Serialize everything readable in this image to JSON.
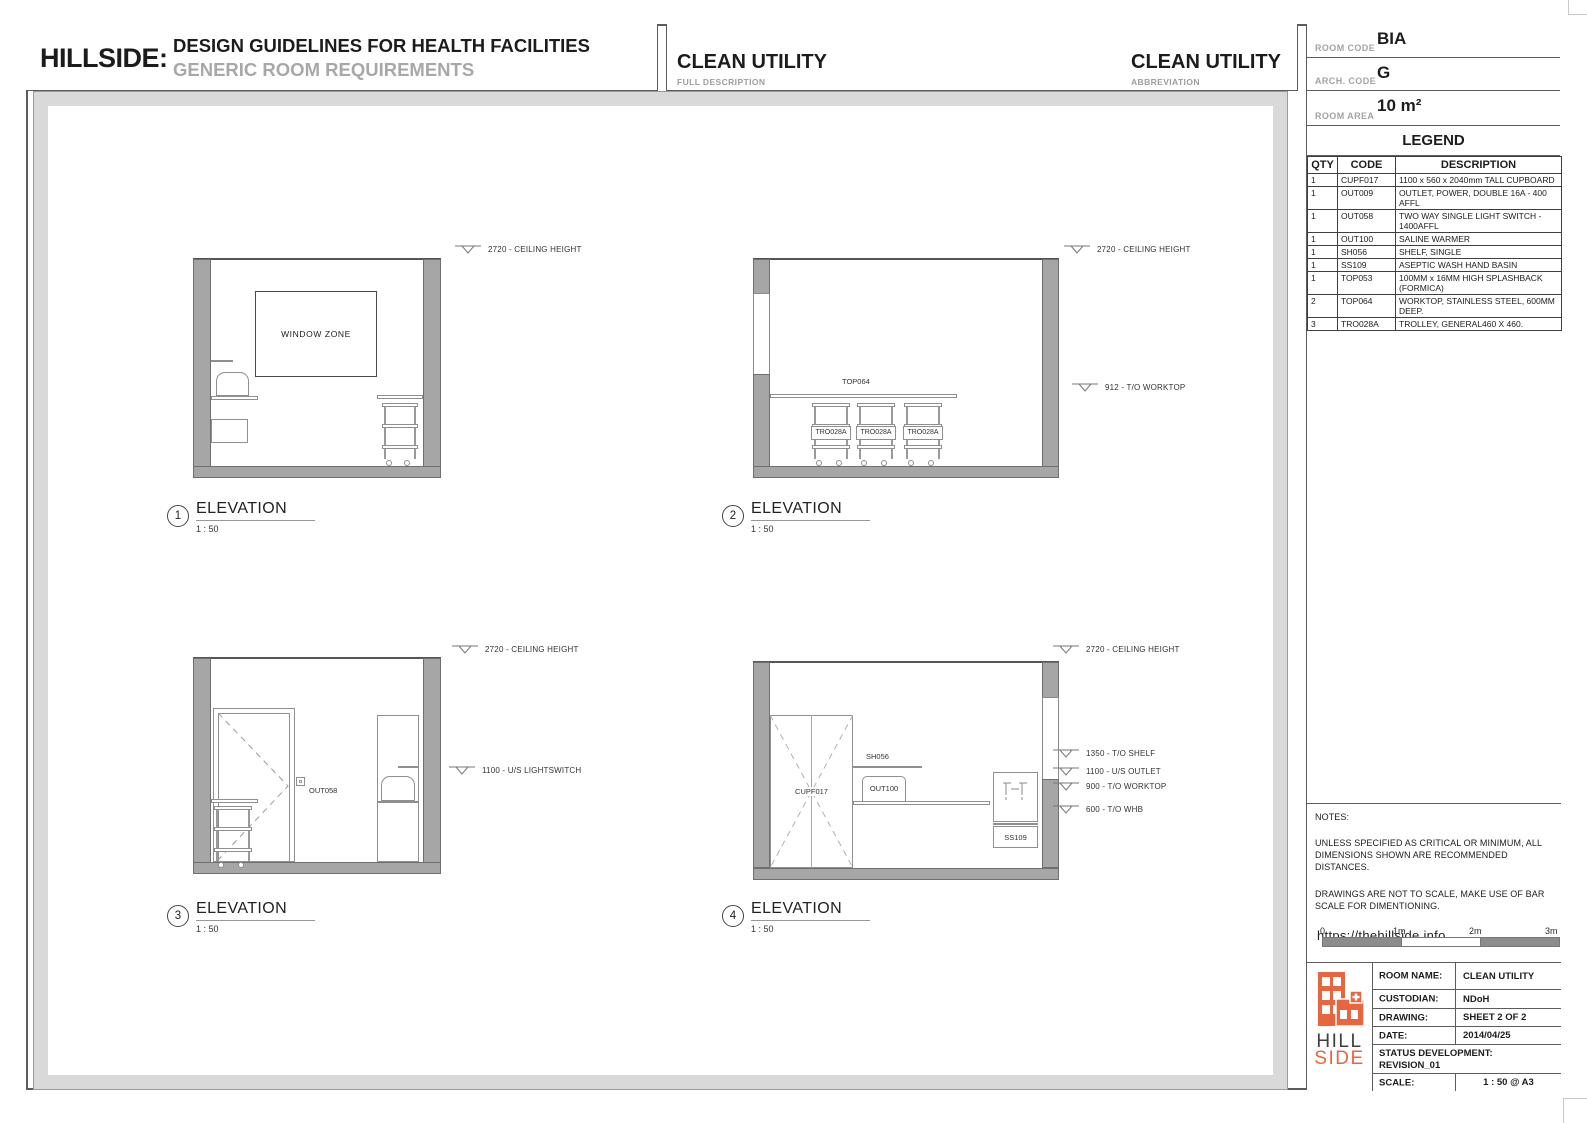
{
  "header": {
    "brand": "HILLSIDE:",
    "title": "DESIGN GUIDELINES FOR HEALTH FACILITIES",
    "subtitle": "GENERIC ROOM REQUIREMENTS",
    "full_description": {
      "value": "CLEAN UTILITY",
      "label": "FULL DESCRIPTION"
    },
    "abbreviation": {
      "value": "CLEAN UTILITY",
      "label": "ABBREVIATION"
    }
  },
  "info": {
    "room_code": {
      "label": "ROOM CODE",
      "value": "BIA"
    },
    "arch_code": {
      "label": "ARCH. CODE",
      "value": "G"
    },
    "room_area": {
      "label": "ROOM AREA",
      "value": "10 m²"
    }
  },
  "legend": {
    "title": "LEGEND",
    "columns": [
      "QTY",
      "CODE",
      "DESCRIPTION"
    ],
    "rows": [
      {
        "qty": "1",
        "code": "CUPF017",
        "description": "1100 x 560 x 2040mm TALL CUPBOARD"
      },
      {
        "qty": "1",
        "code": "OUT009",
        "description": "OUTLET, POWER, DOUBLE 16A - 400 AFFL"
      },
      {
        "qty": "1",
        "code": "OUT058",
        "description": "TWO WAY SINGLE LIGHT SWITCH - 1400AFFL"
      },
      {
        "qty": "1",
        "code": "OUT100",
        "description": "SALINE WARMER"
      },
      {
        "qty": "1",
        "code": "SH056",
        "description": "SHELF, SINGLE"
      },
      {
        "qty": "1",
        "code": "SS109",
        "description": "ASEPTIC WASH HAND BASIN"
      },
      {
        "qty": "1",
        "code": "TOP053",
        "description": "100MM x 16MM HIGH SPLASHBACK (FORMICA)"
      },
      {
        "qty": "2",
        "code": "TOP064",
        "description": "WORKTOP, STAINLESS STEEL, 600MM DEEP."
      },
      {
        "qty": "3",
        "code": "TRO028A",
        "description": "TROLLEY, GENERAL460 X 460."
      }
    ]
  },
  "elevations": [
    {
      "number": "1",
      "title": "ELEVATION",
      "scale": "1 : 50",
      "annotations": [
        "2720 - CEILING HEIGHT"
      ],
      "labels": {
        "window_zone": "WINDOW ZONE"
      }
    },
    {
      "number": "2",
      "title": "ELEVATION",
      "scale": "1 : 50",
      "annotations": [
        "2720 - CEILING HEIGHT",
        "912 - T/O WORKTOP"
      ],
      "labels": {
        "worktop": "TOP064",
        "trolley1": "TRO028A",
        "trolley2": "TRO028A",
        "trolley3": "TRO028A"
      }
    },
    {
      "number": "3",
      "title": "ELEVATION",
      "scale": "1 : 50",
      "annotations": [
        "2720 - CEILING HEIGHT",
        "1100 - U/S LIGHTSWITCH"
      ],
      "labels": {
        "switch": "OUT058"
      }
    },
    {
      "number": "4",
      "title": "ELEVATION",
      "scale": "1 : 50",
      "annotations": [
        "2720 - CEILING HEIGHT",
        "1350 - T/O SHELF",
        "1100 - U/S OUTLET",
        "900 - T/O WORKTOP",
        "600 - T/O WHB"
      ],
      "labels": {
        "cupboard": "CUPF017",
        "shelf": "SH056",
        "warmer": "OUT100",
        "basin": "SS109"
      }
    }
  ],
  "notes": {
    "title": "NOTES:",
    "para1": "UNLESS SPECIFIED AS CRITICAL OR MINIMUM, ALL DIMENSIONS SHOWN ARE RECOMMENDED DISTANCES.",
    "para2": "DRAWINGS ARE NOT TO SCALE, MAKE USE OF BAR SCALE FOR DIMENTIONING.",
    "url": "https://thehillside.info"
  },
  "bar_scale": {
    "ticks": [
      "0",
      "1m",
      "2m",
      "3m"
    ]
  },
  "title_block": {
    "rows": [
      {
        "label": "ROOM NAME:",
        "value": "CLEAN UTILITY"
      },
      {
        "label": "CUSTODIAN:",
        "value": "NDoH"
      },
      {
        "label": "DRAWING:",
        "value": "SHEET 2 OF 2"
      },
      {
        "label": "DATE:",
        "value": "2014/04/25"
      }
    ],
    "status_label": "STATUS DEVELOPMENT:",
    "status_value": "REVISION_01",
    "scale_label": "SCALE:",
    "scale_value": "1 : 50 @ A3",
    "logo": {
      "line1": "HILL",
      "line2": "SIDE"
    }
  },
  "colors": {
    "accent_orange": "#E8663F",
    "wall_gray": "#A6A6A6",
    "frame_gray": "#D9D9D9"
  }
}
